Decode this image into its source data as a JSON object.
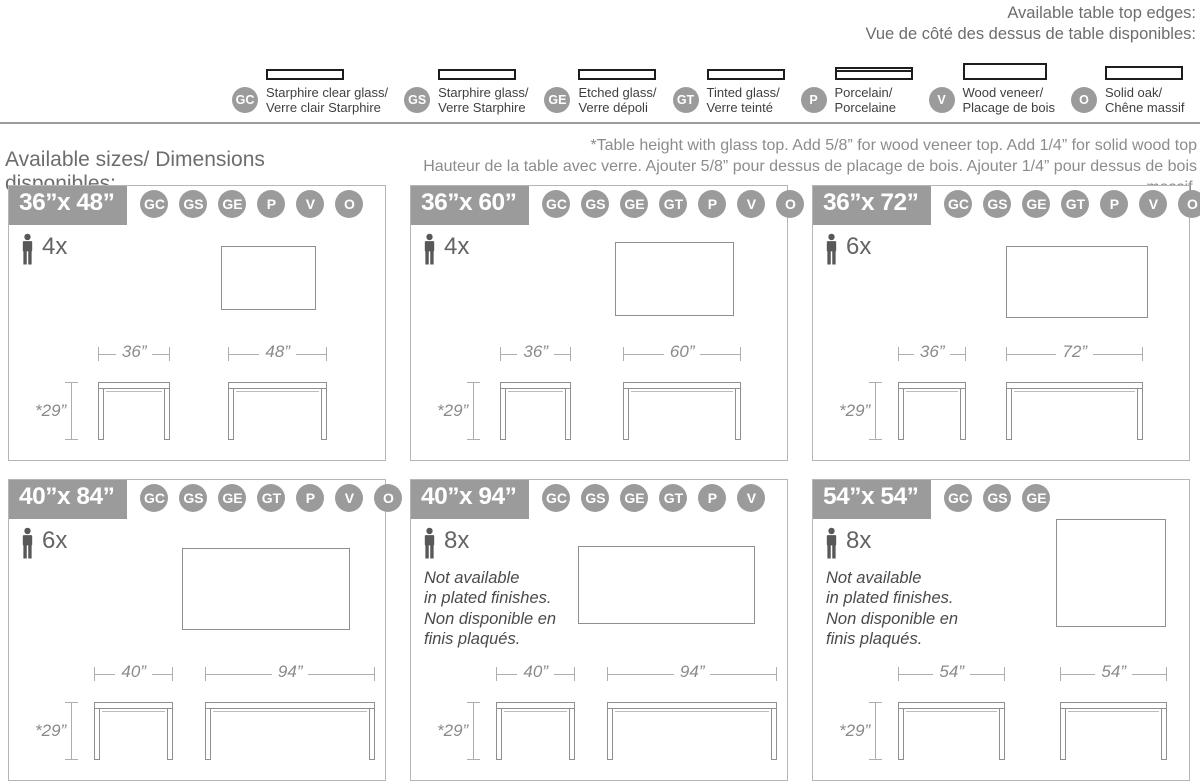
{
  "colors": {
    "badge_gray": "#9b9b9b",
    "heading_gray": "#6d6d6f",
    "note_gray": "#8c8c8e",
    "dark_text": "#3f3f41",
    "drawing_line": "#8f8f8f",
    "panel_border": "#b5b5b5"
  },
  "edges_header": {
    "title_en": "Available table top edges:",
    "title_fr": "Vue de côté des dessus de table disponibles:"
  },
  "edge_types": [
    {
      "code": "GC",
      "label_en": "Starphire clear glass/",
      "label_fr": "Verre clair Starphire"
    },
    {
      "code": "GS",
      "label_en": "Starphire glass/",
      "label_fr": "Verre Starphire"
    },
    {
      "code": "GE",
      "label_en": "Etched glass/",
      "label_fr": "Verre dépoli"
    },
    {
      "code": "GT",
      "label_en": "Tinted glass/",
      "label_fr": "Verre teinté"
    },
    {
      "code": "P",
      "label_en": "Porcelain/",
      "label_fr": "Porcelaine"
    },
    {
      "code": "V",
      "label_en": "Wood veneer/",
      "label_fr": "Placage de bois"
    },
    {
      "code": "O",
      "label_en": "Solid oak/",
      "label_fr": "Chêne massif"
    }
  ],
  "height_note": "*Table height with glass top. Add 5/8” for wood veneer top. Add 1/4” for solid wood top\nHauteur de la table avec verre. Ajouter 5/8” pour dessus de placage de bois. Ajouter 1/4” pour dessus de bois massif.",
  "sizes_heading": "Available sizes/ Dimensions disponibles:",
  "panels": [
    {
      "title": "36”x 48”",
      "badges": [
        "GC",
        "GS",
        "GE",
        "P",
        "V",
        "O"
      ],
      "capacity": "4x",
      "note": "",
      "dim_short": "36”",
      "dim_long": "48”",
      "dim_height": "*29”"
    },
    {
      "title": "36”x 60”",
      "badges": [
        "GC",
        "GS",
        "GE",
        "GT",
        "P",
        "V",
        "O"
      ],
      "capacity": "4x",
      "note": "",
      "dim_short": "36”",
      "dim_long": "60”",
      "dim_height": "*29”"
    },
    {
      "title": "36”x 72”",
      "badges": [
        "GC",
        "GS",
        "GE",
        "GT",
        "P",
        "V",
        "O"
      ],
      "capacity": "6x",
      "note": "",
      "dim_short": "36”",
      "dim_long": "72”",
      "dim_height": "*29”"
    },
    {
      "title": "40”x 84”",
      "badges": [
        "GC",
        "GS",
        "GE",
        "GT",
        "P",
        "V",
        "O"
      ],
      "capacity": "6x",
      "note": "",
      "dim_short": "40”",
      "dim_long": "94”",
      "dim_height": "*29”"
    },
    {
      "title": "40”x 94”",
      "badges": [
        "GC",
        "GS",
        "GE",
        "GT",
        "P",
        "V"
      ],
      "capacity": "8x",
      "note": "Not available\nin plated finishes.\nNon disponible en\nfinis plaqués.",
      "dim_short": "40”",
      "dim_long": "94”",
      "dim_height": "*29”"
    },
    {
      "title": "54”x 54”",
      "badges": [
        "GC",
        "GS",
        "GE"
      ],
      "capacity": "8x",
      "note": "Not available\nin plated finishes.\nNon disponible en\nfinis plaqués.",
      "dim_short": "54”",
      "dim_long": "54”",
      "dim_height": "*29”"
    }
  ]
}
